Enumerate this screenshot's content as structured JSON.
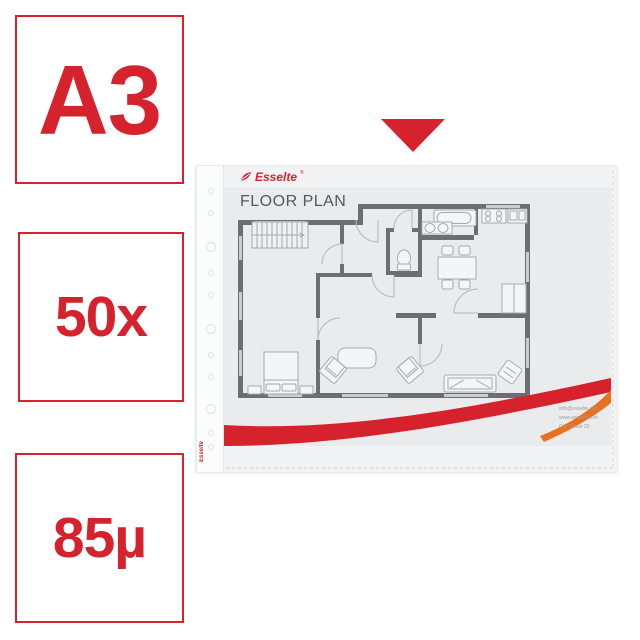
{
  "colors": {
    "accent_red": "#d6222d",
    "swoosh_orange": "#e8701e",
    "wall_gray": "#6b6f73",
    "furniture_gray": "#a6aaae",
    "paper_gray": "#e9ebed"
  },
  "badges": [
    {
      "label": "A3"
    },
    {
      "label": "50x"
    },
    {
      "label": "85µ"
    }
  ],
  "pointer": {
    "icon": "triangle-down"
  },
  "product": {
    "brand": "Esselte",
    "brand_registered": "®",
    "doc_title": "FLOOR PLAN",
    "side_brand": "Esselte",
    "contact_lines": [
      "info@esselte.com",
      "www.esselte.com",
      "City Street 20"
    ]
  }
}
